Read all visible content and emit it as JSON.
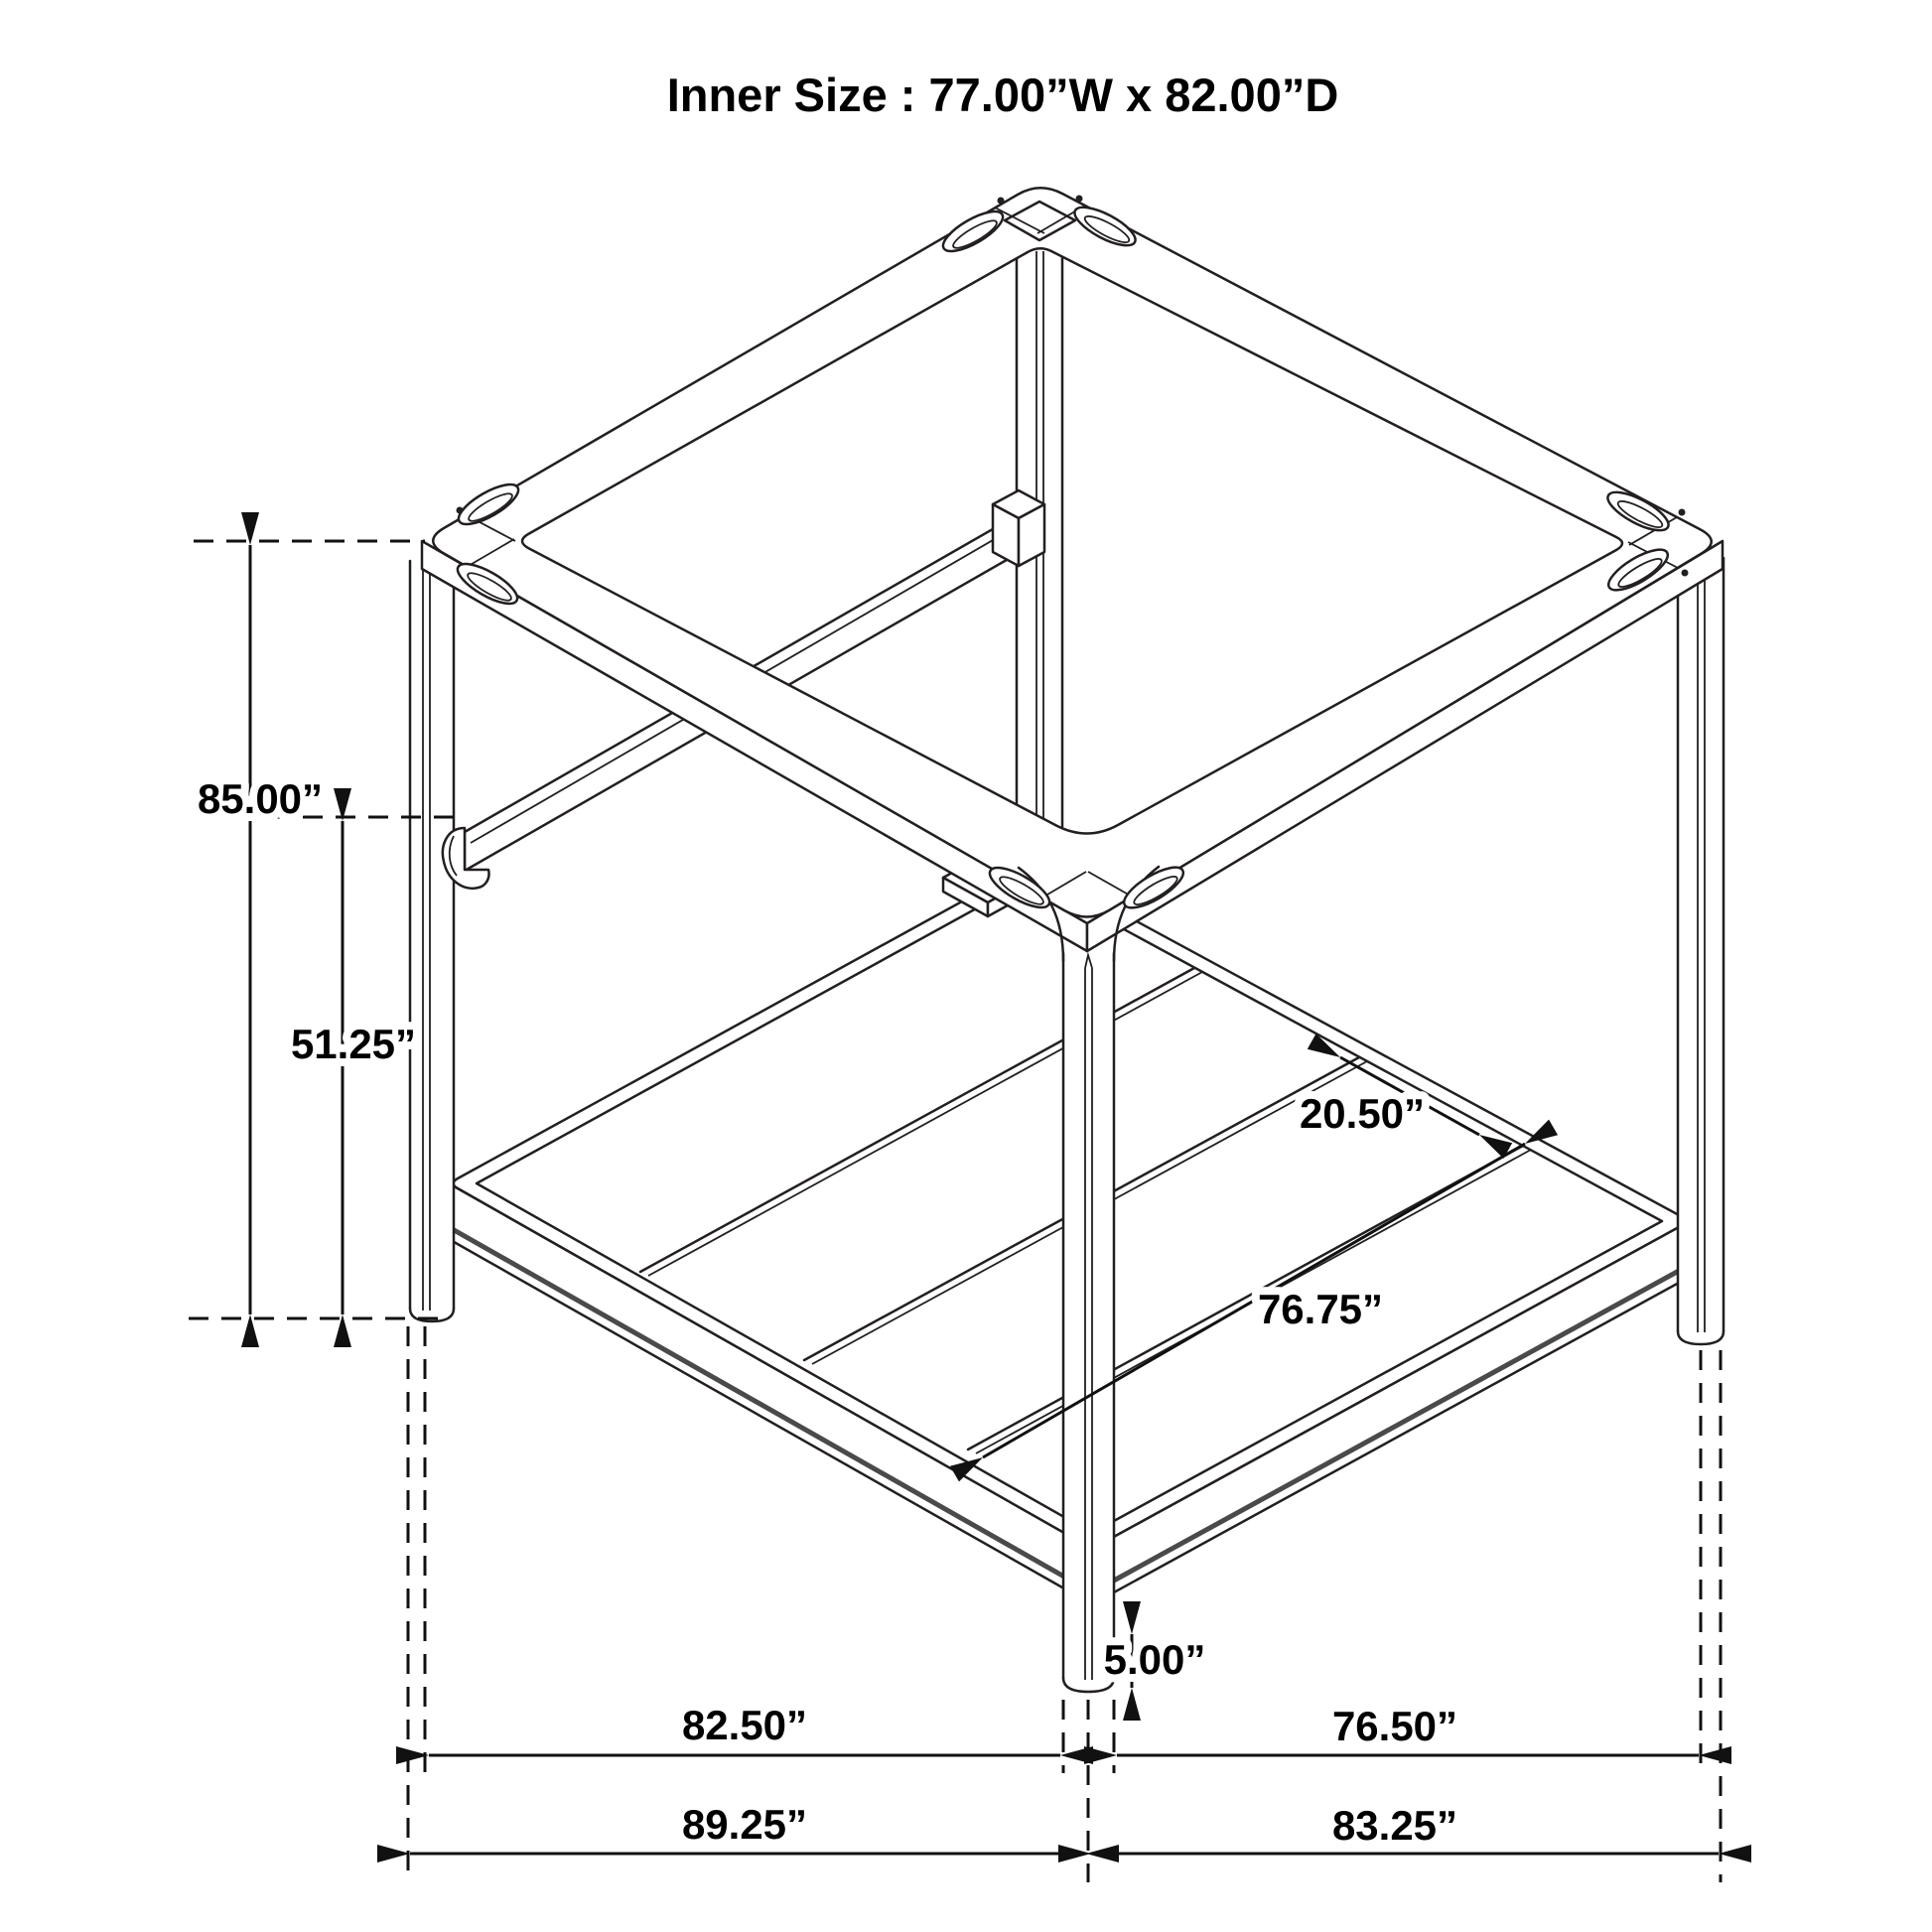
{
  "title": "Inner Size : 77.00”W x 82.00”D",
  "dimensions": {
    "overall_height": "85.00”",
    "rail_height": "51.25”",
    "slat_spacing": "20.50”",
    "slat_length": "76.75”",
    "ground_clearance": "5.00”",
    "side_a_inner_span": "82.50”",
    "side_b_inner_span": "76.50”",
    "side_a_outer_span": "89.25”",
    "side_b_outer_span": "83.25”"
  },
  "colors": {
    "background": "#ffffff",
    "line": "#231f20",
    "dimension": "#111111",
    "text": "#000000"
  }
}
